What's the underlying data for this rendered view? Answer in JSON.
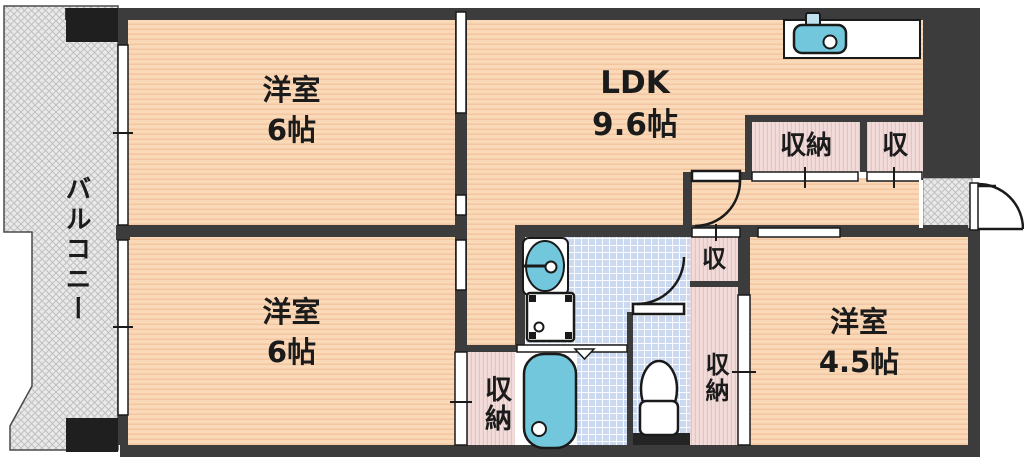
{
  "title": "2LDK apartment floor plan",
  "balcony": {
    "label": "バルコニー"
  },
  "rooms": [
    {
      "id": "bedroom-top-left",
      "name": "洋室",
      "size": "6帖"
    },
    {
      "id": "ldk",
      "name": "LDK",
      "size": "9.6帖"
    },
    {
      "id": "bedroom-bottom-left",
      "name": "洋室",
      "size": "6帖"
    },
    {
      "id": "bedroom-right",
      "name": "洋室",
      "size": "4.5帖"
    }
  ],
  "closets": {
    "top_main": "収納",
    "top_small": "収",
    "mid_small": "収",
    "right_tall": "収納",
    "bottom_left": "収納"
  },
  "fixtures": [
    "kitchen-sink",
    "wash-basin",
    "washing-machine-pan",
    "bathtub",
    "toilet",
    "entrance-tile"
  ],
  "colors": {
    "wall": "#3c3c3c",
    "room_floor": "#f9d9b8",
    "room_stripe": "#eeb28c",
    "closet_floor": "#f2dbd9",
    "closet_stripe": "#d9b9bd",
    "tile_floor": "#cbd9f0",
    "fixture_teal": "#72c7dc",
    "balcony_gray": "#e9e9e9"
  }
}
